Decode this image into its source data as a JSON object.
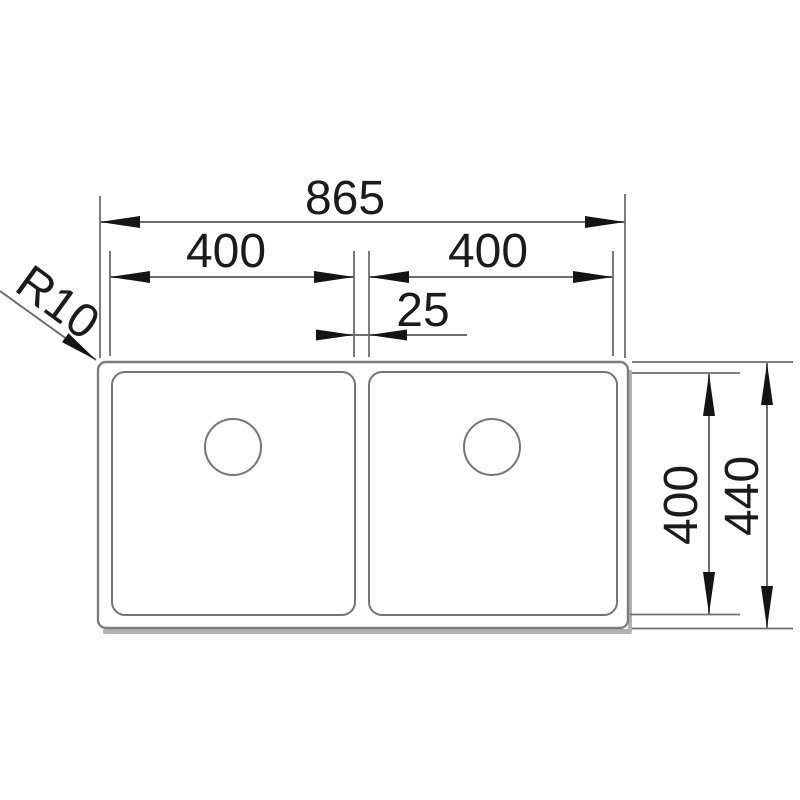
{
  "drawing": {
    "kind": "technical-dimension-drawing",
    "subject": "double-bowl sink, top view",
    "labels": {
      "overall_width": "865",
      "left_bowl_width": "400",
      "right_bowl_width": "400",
      "divider_width": "25",
      "bowl_depth": "400",
      "overall_depth": "440",
      "corner_radius": "R10"
    },
    "colors": {
      "background": "#ffffff",
      "sink_outline": "#7e7e7e",
      "dimension_line": "#6d6d6d",
      "arrowhead": "#141414",
      "text": "#1b1b1b",
      "shadow": "#b2b2b2"
    }
  }
}
